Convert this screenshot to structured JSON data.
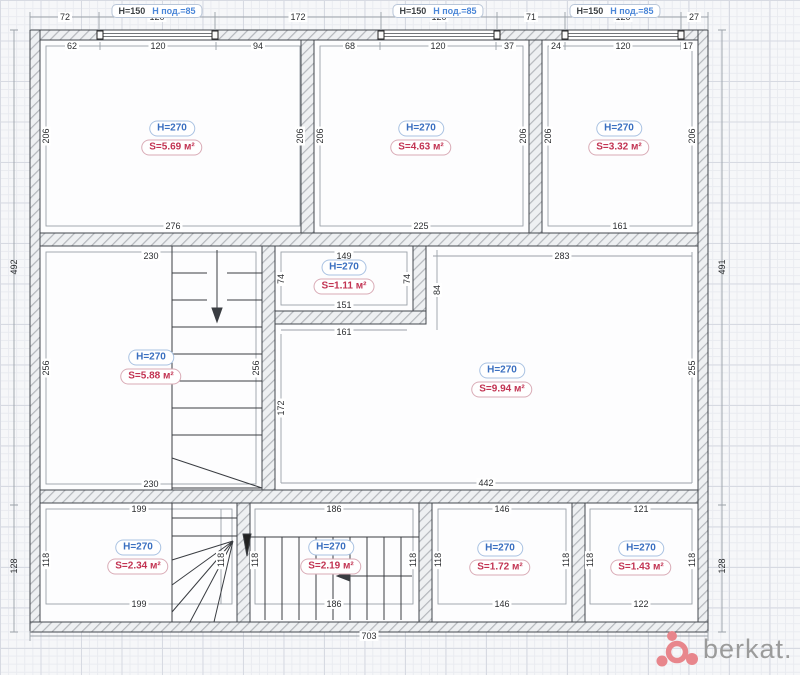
{
  "colors": {
    "room_height_text": "#3a6fc0",
    "room_area_text": "#c23352",
    "window_label_blue": "#4a86d8",
    "wall_outline": "#43474d",
    "logo_pink": "#e8868c",
    "logo_gray": "#9b9b9b"
  },
  "logo": {
    "text": "berkat."
  },
  "window_headers": [
    {
      "h": "H=150",
      "sub": "H под.=85",
      "x": 157,
      "y": 11
    },
    {
      "h": "H=150",
      "sub": "H под.=85",
      "x": 438,
      "y": 11
    },
    {
      "h": "H=150",
      "sub": "H под.=85",
      "x": 615,
      "y": 11
    }
  ],
  "rooms": [
    {
      "h": "H=270",
      "s": "S=5.69 м²",
      "x": 172,
      "y": 138
    },
    {
      "h": "H=270",
      "s": "S=4.63 м²",
      "x": 421,
      "y": 138
    },
    {
      "h": "H=270",
      "s": "S=3.32 м²",
      "x": 619,
      "y": 138
    },
    {
      "h": "H=270",
      "s": "S=1.11 м²",
      "x": 344,
      "y": 277
    },
    {
      "h": "H=270",
      "s": "S=5.88 м²",
      "x": 151,
      "y": 367
    },
    {
      "h": "H=270",
      "s": "S=9.94 м²",
      "x": 502,
      "y": 380
    },
    {
      "h": "H=270",
      "s": "S=2.34 м²",
      "x": 138,
      "y": 557
    },
    {
      "h": "H=270",
      "s": "S=2.19 м²",
      "x": 331,
      "y": 557
    },
    {
      "h": "H=270",
      "s": "S=1.72 м²",
      "x": 500,
      "y": 558
    },
    {
      "h": "H=270",
      "s": "S=1.43 м²",
      "x": 641,
      "y": 558
    }
  ],
  "dims": {
    "labels": [
      {
        "t": "72",
        "x": 65,
        "y": 17
      },
      {
        "t": "120",
        "x": 157,
        "y": 17
      },
      {
        "t": "172",
        "x": 298,
        "y": 17
      },
      {
        "t": "120",
        "x": 439,
        "y": 17
      },
      {
        "t": "71",
        "x": 531,
        "y": 17
      },
      {
        "t": "120",
        "x": 623,
        "y": 17
      },
      {
        "t": "27",
        "x": 694,
        "y": 17
      },
      {
        "t": "62",
        "x": 72,
        "y": 46
      },
      {
        "t": "120",
        "x": 158,
        "y": 46
      },
      {
        "t": "94",
        "x": 258,
        "y": 46
      },
      {
        "t": "68",
        "x": 350,
        "y": 46
      },
      {
        "t": "120",
        "x": 438,
        "y": 46
      },
      {
        "t": "37",
        "x": 509,
        "y": 46
      },
      {
        "t": "24",
        "x": 556,
        "y": 46
      },
      {
        "t": "120",
        "x": 623,
        "y": 46
      },
      {
        "t": "17",
        "x": 688,
        "y": 46
      },
      {
        "t": "206",
        "x": 46,
        "y": 136,
        "rot": 1
      },
      {
        "t": "206",
        "x": 300,
        "y": 136,
        "rot": 1
      },
      {
        "t": "206",
        "x": 320,
        "y": 136,
        "rot": 1
      },
      {
        "t": "206",
        "x": 523,
        "y": 136,
        "rot": 1
      },
      {
        "t": "206",
        "x": 548,
        "y": 136,
        "rot": 1
      },
      {
        "t": "206",
        "x": 692,
        "y": 136,
        "rot": 1
      },
      {
        "t": "276",
        "x": 173,
        "y": 226
      },
      {
        "t": "225",
        "x": 421,
        "y": 226
      },
      {
        "t": "161",
        "x": 620,
        "y": 226
      },
      {
        "t": "230",
        "x": 151,
        "y": 256
      },
      {
        "t": "149",
        "x": 344,
        "y": 256
      },
      {
        "t": "283",
        "x": 562,
        "y": 256
      },
      {
        "t": "74",
        "x": 281,
        "y": 279,
        "rot": 1
      },
      {
        "t": "74",
        "x": 407,
        "y": 279,
        "rot": 1
      },
      {
        "t": "151",
        "x": 344,
        "y": 305
      },
      {
        "t": "84",
        "x": 437,
        "y": 290,
        "rot": 1
      },
      {
        "t": "161",
        "x": 344,
        "y": 332
      },
      {
        "t": "172",
        "x": 281,
        "y": 408,
        "rot": 1
      },
      {
        "t": "256",
        "x": 46,
        "y": 368,
        "rot": 1
      },
      {
        "t": "256",
        "x": 256,
        "y": 368,
        "rot": 1
      },
      {
        "t": "230",
        "x": 151,
        "y": 484
      },
      {
        "t": "255",
        "x": 692,
        "y": 368,
        "rot": 1
      },
      {
        "t": "442",
        "x": 486,
        "y": 483
      },
      {
        "t": "199",
        "x": 139,
        "y": 509
      },
      {
        "t": "118",
        "x": 46,
        "y": 560,
        "rot": 1
      },
      {
        "t": "118",
        "x": 221,
        "y": 560,
        "rot": 1
      },
      {
        "t": "199",
        "x": 139,
        "y": 604
      },
      {
        "t": "186",
        "x": 334,
        "y": 509
      },
      {
        "t": "118",
        "x": 255,
        "y": 560,
        "rot": 1
      },
      {
        "t": "118",
        "x": 413,
        "y": 560,
        "rot": 1
      },
      {
        "t": "186",
        "x": 334,
        "y": 604
      },
      {
        "t": "146",
        "x": 502,
        "y": 509
      },
      {
        "t": "118",
        "x": 438,
        "y": 560,
        "rot": 1
      },
      {
        "t": "118",
        "x": 566,
        "y": 560,
        "rot": 1
      },
      {
        "t": "146",
        "x": 502,
        "y": 604
      },
      {
        "t": "121",
        "x": 641,
        "y": 509
      },
      {
        "t": "118",
        "x": 590,
        "y": 560,
        "rot": 1
      },
      {
        "t": "118",
        "x": 692,
        "y": 560,
        "rot": 1
      },
      {
        "t": "122",
        "x": 641,
        "y": 604
      },
      {
        "t": "492",
        "x": 14,
        "y": 267,
        "rot": 1,
        "outer": 1
      },
      {
        "t": "128",
        "x": 14,
        "y": 566,
        "rot": 1,
        "outer": 1
      },
      {
        "t": "491",
        "x": 722,
        "y": 267,
        "rot": 1,
        "outer": 1
      },
      {
        "t": "128",
        "x": 722,
        "y": 566,
        "rot": 1,
        "outer": 1
      },
      {
        "t": "703",
        "x": 369,
        "y": 636
      }
    ]
  }
}
